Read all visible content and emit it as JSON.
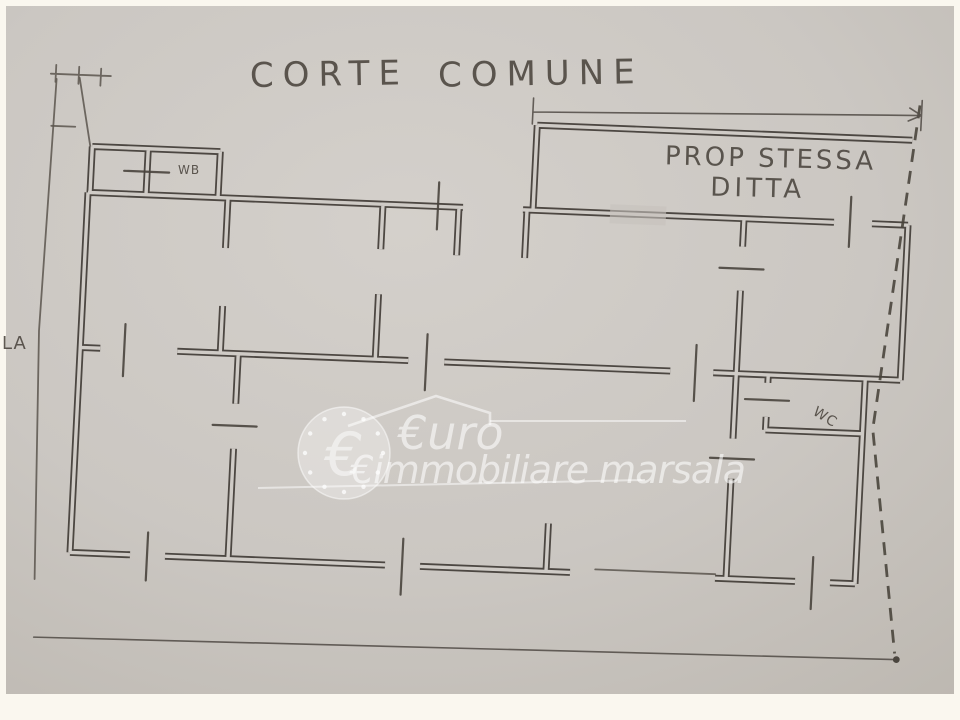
{
  "plan": {
    "title_parts": [
      "CORTE",
      "COMUNE"
    ],
    "annex_label": {
      "line1": "PROP STESSA",
      "line2": "DITTA"
    },
    "rooms": {
      "wb": "WB",
      "wc": "WC"
    },
    "left_label": "LA"
  },
  "watermark": {
    "coin_symbol": "€",
    "line1": "€uro",
    "line2": "€immobiliare marsala"
  },
  "colors": {
    "paper": "#cbc7c2",
    "ink": "#443f39",
    "frame": "#faf7ef",
    "watermark": "#ffffff"
  }
}
